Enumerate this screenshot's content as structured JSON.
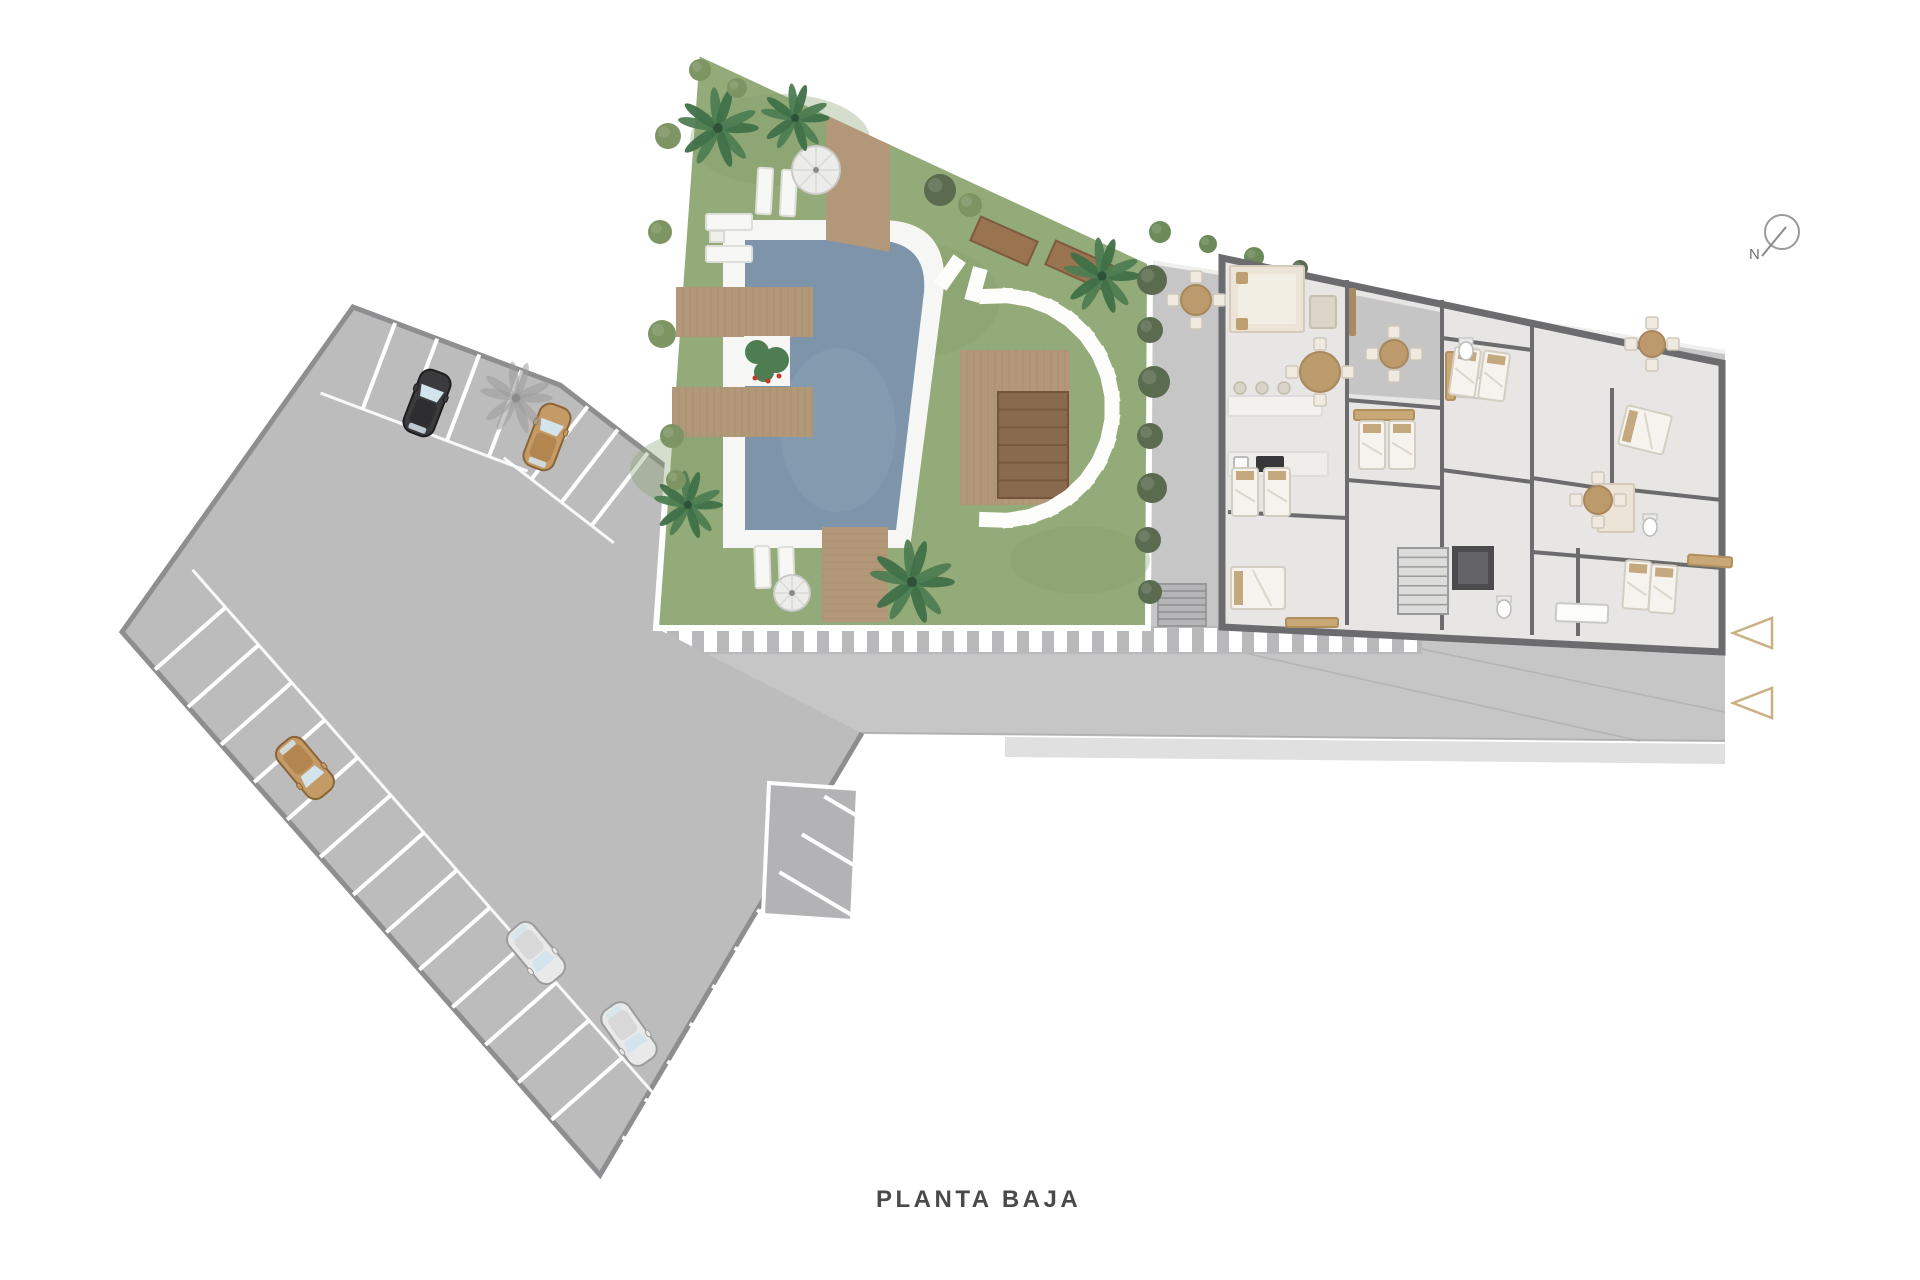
{
  "title": "PLANTA BAJA",
  "compass": {
    "label": "N",
    "cx": 1782,
    "cy": 232,
    "r": 17,
    "needle": [
      1762,
      256,
      1786,
      227
    ],
    "color": "#9a9a9a"
  },
  "entrance_arrows": [
    {
      "tip_x": 1733,
      "tip_y": 633,
      "w": 39,
      "h": 30
    },
    {
      "tip_x": 1733,
      "tip_y": 703,
      "w": 39,
      "h": 30
    }
  ],
  "colors": {
    "background": "#ffffff",
    "lot_fill": "#bcbcbd",
    "lot_border": "#8e8e90",
    "stall_line": "#ffffff",
    "road_fill": "#c6c6c7",
    "sidewalk": "#e0e0e0",
    "grass": "#93aa79",
    "grass_patch": "#87a06c",
    "garden_border": "#ffffff",
    "pool_water": "#7d94aa",
    "pool_sheen": "#8ba0b2",
    "pool_coping": "#f6f6f4",
    "deck_wood": "#b29878",
    "deck_line": "#a18a6d",
    "pergola": "#8a6a4e",
    "planter_bed": "#9a7450",
    "palm_a": "#3f7048",
    "palm_b": "#4e7d52",
    "palm_core": "#2e5238",
    "palm_shadow": "#9a9a9a",
    "hedge": "#5a6b4f",
    "bush": "#7c9562",
    "topiary": "#6d8a5a",
    "wall": "#6c6c6f",
    "floor": "#e7e6e4",
    "patio": "#c5c5c6",
    "bed_sheet": "#f6f3ee",
    "bed_edge": "#d3cec2",
    "pillow": "#c3a97d",
    "sofa": "#ece5d7",
    "sofa_edge": "#d6cbba",
    "wood_furniture": "#bd9a6b",
    "stone": "#fdfdfc",
    "stripe_base": "#b9b9bb",
    "arrow_stroke": "#c9b183",
    "title_color": "#4a4a48",
    "car_window": "#d3e4ed"
  },
  "scene": {
    "road_poly": "1148,262 1725,352 1725,741 862,733 646,628 1148,628",
    "site_boundary_line": [
      1150,
      262,
      1725,
      352
    ],
    "sidewalk_poly": "1005,737 1725,744 1725,764 1005,757",
    "road_lines": [
      [
        1150,
        632,
        1640,
        741
      ],
      [
        1340,
        632,
        1725,
        712
      ]
    ],
    "stripes": {
      "x1": 650,
      "x2": 1418,
      "y": 626,
      "h": 28,
      "step": 25,
      "bar_w": 13
    },
    "garden_stairs": {
      "x": 1158,
      "y": 584,
      "w": 48,
      "h": 42,
      "steps": 6
    },
    "lot_poly": "353,307 560,385 670,470 656,628 862,733 600,1175 122,632",
    "lot_border_path": "M862,733 L600,1175 L122,632 L353,307 L560,385 L670,470",
    "special_stall": "769,783 858,789 852,921 763,915",
    "stall_rows": [
      {
        "edge": [
          353,
          307,
          560,
          385
        ],
        "depth": 92,
        "from": 45,
        "step": 45,
        "count": 4,
        "side": 1
      },
      {
        "edge": [
          560,
          385,
          670,
          470
        ],
        "depth": 92,
        "from": 35,
        "step": 38,
        "count": 3,
        "side": 1
      },
      {
        "edge": [
          122,
          632,
          600,
          1175
        ],
        "depth": 94,
        "from": 50,
        "step": 50,
        "count": 13,
        "side": -1
      },
      {
        "edge": [
          600,
          1175,
          862,
          733
        ],
        "depth": 94,
        "from": 44,
        "step": 44,
        "count": 10,
        "side": 1
      }
    ],
    "cars": [
      {
        "name": "car-black",
        "x": 427,
        "y": 403,
        "rot": 21,
        "body": "#3b3b3d",
        "roof": "#2e2e30",
        "trim": "#1e1e1f"
      },
      {
        "name": "car-tan-1",
        "x": 547,
        "y": 437,
        "rot": 21,
        "body": "#c49a66",
        "roof": "#b3854f",
        "trim": "#8a6436"
      },
      {
        "name": "car-tan-2",
        "x": 305,
        "y": 768,
        "rot": 140,
        "body": "#c49a66",
        "roof": "#b3854f",
        "trim": "#8a6436"
      },
      {
        "name": "car-white-1",
        "x": 536,
        "y": 953,
        "rot": 140,
        "body": "#e9e9e9",
        "roof": "#d8d8d8",
        "trim": "#9c9c9c"
      },
      {
        "name": "car-white-2",
        "x": 629,
        "y": 1034,
        "rot": 145,
        "body": "#e9e9e9",
        "roof": "#d8d8d8",
        "trim": "#9c9c9c"
      }
    ],
    "garden_poly": "697,52 1150,262 1148,628 656,628",
    "grass_patches": [
      [
        780,
        140,
        90,
        46
      ],
      [
        710,
        470,
        80,
        40
      ],
      [
        1080,
        560,
        70,
        34
      ],
      [
        900,
        300,
        100,
        60
      ]
    ],
    "pool": {
      "coping": "M723,220 L880,220 Q948,220 944,286 L910,548 L723,548 Z",
      "water": "M745,240 L872,240 Q928,240 924,292 L896,530 L745,530 Z",
      "sheen": {
        "cx": 838,
        "cy": 430,
        "rx": 58,
        "ry": 82
      }
    },
    "decks": [
      {
        "name": "deck-top-bridge",
        "poly": "826,115 890,145 890,252 826,240",
        "plank": "h"
      },
      {
        "name": "deck-jetty-upper",
        "x": 676,
        "y": 287,
        "w": 137,
        "h": 50,
        "plank": "v"
      },
      {
        "name": "deck-jetty-lower",
        "x": 672,
        "y": 387,
        "w": 141,
        "h": 50,
        "plank": "v"
      },
      {
        "name": "deck-pool-south",
        "x": 822,
        "y": 527,
        "w": 66,
        "h": 95,
        "plank": "h"
      },
      {
        "name": "deck-arc-inner",
        "x": 960,
        "y": 350,
        "w": 110,
        "h": 155,
        "plank": "v"
      }
    ],
    "pergola": {
      "x": 998,
      "y": 392,
      "w": 70,
      "h": 106,
      "slats": 6
    },
    "planter_beds": [
      {
        "x": 973,
        "y": 228,
        "w": 62,
        "h": 26,
        "rot": 24
      },
      {
        "x": 1048,
        "y": 252,
        "w": 62,
        "h": 26,
        "rot": 24
      }
    ],
    "pool_planter": {
      "x": 744,
      "y": 336,
      "w": 46,
      "h": 50,
      "plants": [
        [
          757,
          352,
          12
        ],
        [
          776,
          360,
          13
        ],
        [
          764,
          372,
          10
        ]
      ],
      "flowers": [
        [
          755,
          378
        ],
        [
          768,
          381
        ],
        [
          779,
          376
        ]
      ]
    },
    "parasols": [
      {
        "x": 816,
        "y": 170,
        "r": 24
      },
      {
        "x": 792,
        "y": 593,
        "r": 18
      }
    ],
    "loungers": [
      {
        "x": 757,
        "y": 168,
        "w": 15,
        "h": 46,
        "rot": 3
      },
      {
        "x": 781,
        "y": 170,
        "w": 15,
        "h": 46,
        "rot": 3
      },
      {
        "x": 755,
        "y": 546,
        "w": 15,
        "h": 42,
        "rot": -2
      },
      {
        "x": 779,
        "y": 547,
        "w": 15,
        "h": 42,
        "rot": -2
      },
      {
        "x": 706,
        "y": 214,
        "w": 46,
        "h": 16,
        "rot": 0
      },
      {
        "x": 706,
        "y": 246,
        "w": 46,
        "h": 16,
        "rot": 0
      }
    ],
    "side_table": {
      "x": 710,
      "y": 231,
      "w": 14,
      "h": 11
    },
    "stones_arc": {
      "cx": 1000,
      "cy": 408,
      "r": 112,
      "a1": -92,
      "a2": 92,
      "count": 17,
      "w": 34,
      "h": 15
    },
    "lead_stones": [
      {
        "x": 950,
        "y": 272,
        "rot": -55
      },
      {
        "x": 976,
        "y": 284,
        "rot": -75
      }
    ],
    "palms": [
      {
        "x": 718,
        "y": 128,
        "r": 40
      },
      {
        "x": 795,
        "y": 118,
        "r": 34
      },
      {
        "x": 688,
        "y": 505,
        "r": 34
      },
      {
        "x": 912,
        "y": 582,
        "r": 42
      },
      {
        "x": 1102,
        "y": 276,
        "r": 38
      }
    ],
    "palm_shadow": {
      "x": 516,
      "y": 398,
      "r": 36
    },
    "bushes": [
      {
        "x": 668,
        "y": 136,
        "r": 13,
        "c": "bush"
      },
      {
        "x": 660,
        "y": 232,
        "r": 12,
        "c": "bush"
      },
      {
        "x": 662,
        "y": 334,
        "r": 14,
        "c": "bush"
      },
      {
        "x": 672,
        "y": 436,
        "r": 12,
        "c": "bush"
      },
      {
        "x": 700,
        "y": 70,
        "r": 11,
        "c": "bush"
      },
      {
        "x": 737,
        "y": 88,
        "r": 10,
        "c": "bush"
      },
      {
        "x": 676,
        "y": 480,
        "r": 10,
        "c": "bush"
      },
      {
        "x": 940,
        "y": 190,
        "r": 16,
        "c": "hedge"
      },
      {
        "x": 970,
        "y": 205,
        "r": 12,
        "c": "bush"
      },
      {
        "x": 1152,
        "y": 280,
        "r": 15,
        "c": "hedge"
      },
      {
        "x": 1150,
        "y": 330,
        "r": 13,
        "c": "hedge"
      },
      {
        "x": 1154,
        "y": 382,
        "r": 16,
        "c": "hedge"
      },
      {
        "x": 1150,
        "y": 436,
        "r": 13,
        "c": "hedge"
      },
      {
        "x": 1152,
        "y": 488,
        "r": 15,
        "c": "hedge"
      },
      {
        "x": 1148,
        "y": 540,
        "r": 13,
        "c": "hedge"
      },
      {
        "x": 1150,
        "y": 592,
        "r": 12,
        "c": "hedge"
      },
      {
        "x": 1160,
        "y": 232,
        "r": 11,
        "c": "topiary"
      },
      {
        "x": 1208,
        "y": 244,
        "r": 9,
        "c": "topiary"
      },
      {
        "x": 1254,
        "y": 257,
        "r": 10,
        "c": "topiary"
      },
      {
        "x": 1300,
        "y": 268,
        "r": 8,
        "c": "hedge"
      },
      {
        "x": 1402,
        "y": 303,
        "r": 9,
        "c": "topiary"
      },
      {
        "x": 1524,
        "y": 330,
        "r": 8,
        "c": "topiary"
      },
      {
        "x": 1633,
        "y": 373,
        "r": 8,
        "c": "topiary"
      },
      {
        "x": 1713,
        "y": 415,
        "r": 9,
        "c": "topiary"
      }
    ],
    "building": {
      "footprint": "1222,258 1692,357 1722,363 1722,652 1222,627",
      "patio_poly": "1349,294 1440,312 1440,400 1349,394",
      "walls": [
        [
          1347,
          280,
          1347,
          625
        ],
        [
          1442,
          300,
          1442,
          630
        ],
        [
          1532,
          320,
          1532,
          635
        ],
        [
          1612,
          388,
          1612,
          495
        ],
        [
          1578,
          548,
          1578,
          636
        ],
        [
          1347,
          400,
          1442,
          408
        ],
        [
          1347,
          480,
          1442,
          488
        ],
        [
          1442,
          338,
          1532,
          350
        ],
        [
          1442,
          470,
          1532,
          482
        ],
        [
          1532,
          478,
          1612,
          490
        ],
        [
          1532,
          552,
          1722,
          568
        ],
        [
          1228,
          512,
          1347,
          518
        ],
        [
          1612,
          488,
          1722,
          500
        ]
      ],
      "elevator": {
        "x": 1452,
        "y": 546,
        "w": 42,
        "h": 44
      },
      "stairs": {
        "x": 1398,
        "y": 548,
        "w": 50,
        "h": 66,
        "steps": 7
      },
      "beds_twin": [
        {
          "x": 1372,
          "y": 445,
          "rot": 0
        },
        {
          "x": 1402,
          "y": 445,
          "rot": 0
        },
        {
          "x": 1465,
          "y": 372,
          "rot": 8
        },
        {
          "x": 1494,
          "y": 376,
          "rot": 8
        },
        {
          "x": 1245,
          "y": 492,
          "rot": 0
        },
        {
          "x": 1277,
          "y": 492,
          "rot": 0
        },
        {
          "x": 1637,
          "y": 585,
          "rot": 4
        },
        {
          "x": 1663,
          "y": 589,
          "rot": 4
        }
      ],
      "beds_double": [
        {
          "x": 1258,
          "y": 588,
          "w": 54,
          "h": 42,
          "rot": 0
        },
        {
          "x": 1645,
          "y": 430,
          "w": 46,
          "h": 40,
          "rot": 14
        }
      ],
      "furniture_rects": [
        {
          "name": "sofa-base",
          "x": 1230,
          "y": 266,
          "w": 74,
          "h": 66,
          "f": "#ece5d7",
          "s": "#d6cbba"
        },
        {
          "name": "sofa-seat",
          "x": 1238,
          "y": 274,
          "w": 58,
          "h": 50,
          "f": "#f3eee4",
          "s": "none"
        },
        {
          "name": "sofa-pillow",
          "x": 1236,
          "y": 272,
          "w": 12,
          "h": 12,
          "f": "#bd9f72",
          "s": "none"
        },
        {
          "name": "sofa-pillow",
          "x": 1236,
          "y": 318,
          "w": 12,
          "h": 12,
          "f": "#bd9f72",
          "s": "none"
        },
        {
          "name": "coffee-table",
          "x": 1310,
          "y": 296,
          "w": 26,
          "h": 32,
          "f": "#dbd4c7",
          "s": "#c6bfae"
        },
        {
          "name": "tv-bench",
          "x": 1349,
          "y": 288,
          "w": 7,
          "h": 48,
          "f": "#a98b63",
          "s": "none"
        },
        {
          "name": "kitchen-bar",
          "x": 1228,
          "y": 396,
          "w": 94,
          "h": 20,
          "f": "#f2f1ee",
          "s": "#dddddd"
        },
        {
          "name": "kitchen-counter",
          "x": 1228,
          "y": 452,
          "w": 100,
          "h": 24,
          "f": "#eeedea",
          "s": "#dddddd"
        },
        {
          "name": "cooktop",
          "x": 1256,
          "y": 456,
          "w": 28,
          "h": 16,
          "f": "#38383a",
          "s": "none"
        },
        {
          "name": "kitchen-sink",
          "x": 1234,
          "y": 457,
          "w": 14,
          "h": 13,
          "f": "#fbfbfb",
          "s": "#bbbbbb"
        },
        {
          "name": "bathtub",
          "x": 1447,
          "y": 378,
          "w": 58,
          "h": 20,
          "f": "#fcfcfb",
          "s": "#c9c9c7",
          "rot": 4
        },
        {
          "name": "bathtub",
          "x": 1556,
          "y": 604,
          "w": 52,
          "h": 18,
          "f": "#fcfcfb",
          "s": "#c9c9c7",
          "rot": 2
        },
        {
          "name": "closet",
          "x": 1354,
          "y": 410,
          "w": 60,
          "h": 10,
          "f": "#c9a877",
          "s": "#b08f5c"
        },
        {
          "name": "closet",
          "x": 1446,
          "y": 352,
          "w": 9,
          "h": 48,
          "f": "#c9a877",
          "s": "#b08f5c"
        },
        {
          "name": "closet",
          "x": 1688,
          "y": 556,
          "w": 44,
          "h": 10,
          "f": "#c9a877",
          "s": "#b08f5c",
          "rot": 4
        },
        {
          "name": "closet",
          "x": 1286,
          "y": 618,
          "w": 52,
          "h": 9,
          "f": "#c9a877",
          "s": "#b08f5c"
        },
        {
          "name": "sofa-2",
          "x": 1598,
          "y": 484,
          "w": 36,
          "h": 48,
          "f": "#ece5d7",
          "s": "#d6cbba"
        }
      ],
      "stools": [
        [
          1240,
          388
        ],
        [
          1262,
          388
        ],
        [
          1284,
          388
        ]
      ],
      "toilets": [
        [
          1466,
          348
        ],
        [
          1504,
          606
        ],
        [
          1650,
          524
        ]
      ],
      "table_sets": [
        {
          "name": "dining-table",
          "x": 1320,
          "y": 372,
          "r": 20
        },
        {
          "name": "terrace-table",
          "x": 1196,
          "y": 300,
          "r": 15
        },
        {
          "name": "patio-table",
          "x": 1394,
          "y": 354,
          "r": 14
        },
        {
          "name": "terrace-table",
          "x": 1652,
          "y": 344,
          "r": 13
        },
        {
          "name": "dining-table-2",
          "x": 1598,
          "y": 500,
          "r": 14
        }
      ]
    }
  }
}
